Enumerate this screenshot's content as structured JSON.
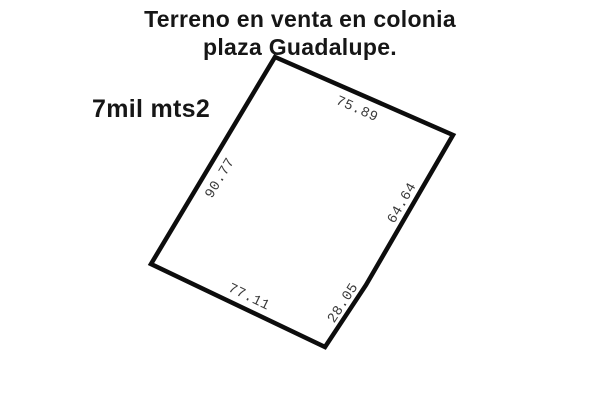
{
  "title": {
    "line1": "Terreno en venta en colonia",
    "line2": "plaza Guadalupe."
  },
  "area_label": "7mil mts2",
  "plot": {
    "sides": [
      {
        "name": "top",
        "length": "75.89"
      },
      {
        "name": "left",
        "length": "90.77"
      },
      {
        "name": "right-upper",
        "length": "64.64"
      },
      {
        "name": "right-lower",
        "length": "28.05"
      },
      {
        "name": "bottom",
        "length": "77.11"
      }
    ]
  },
  "colors": {
    "background": "#ffffff",
    "boundary_line": "#0d0d0d",
    "title_text": "#161616",
    "measurement_text": "#3a3a3a"
  }
}
